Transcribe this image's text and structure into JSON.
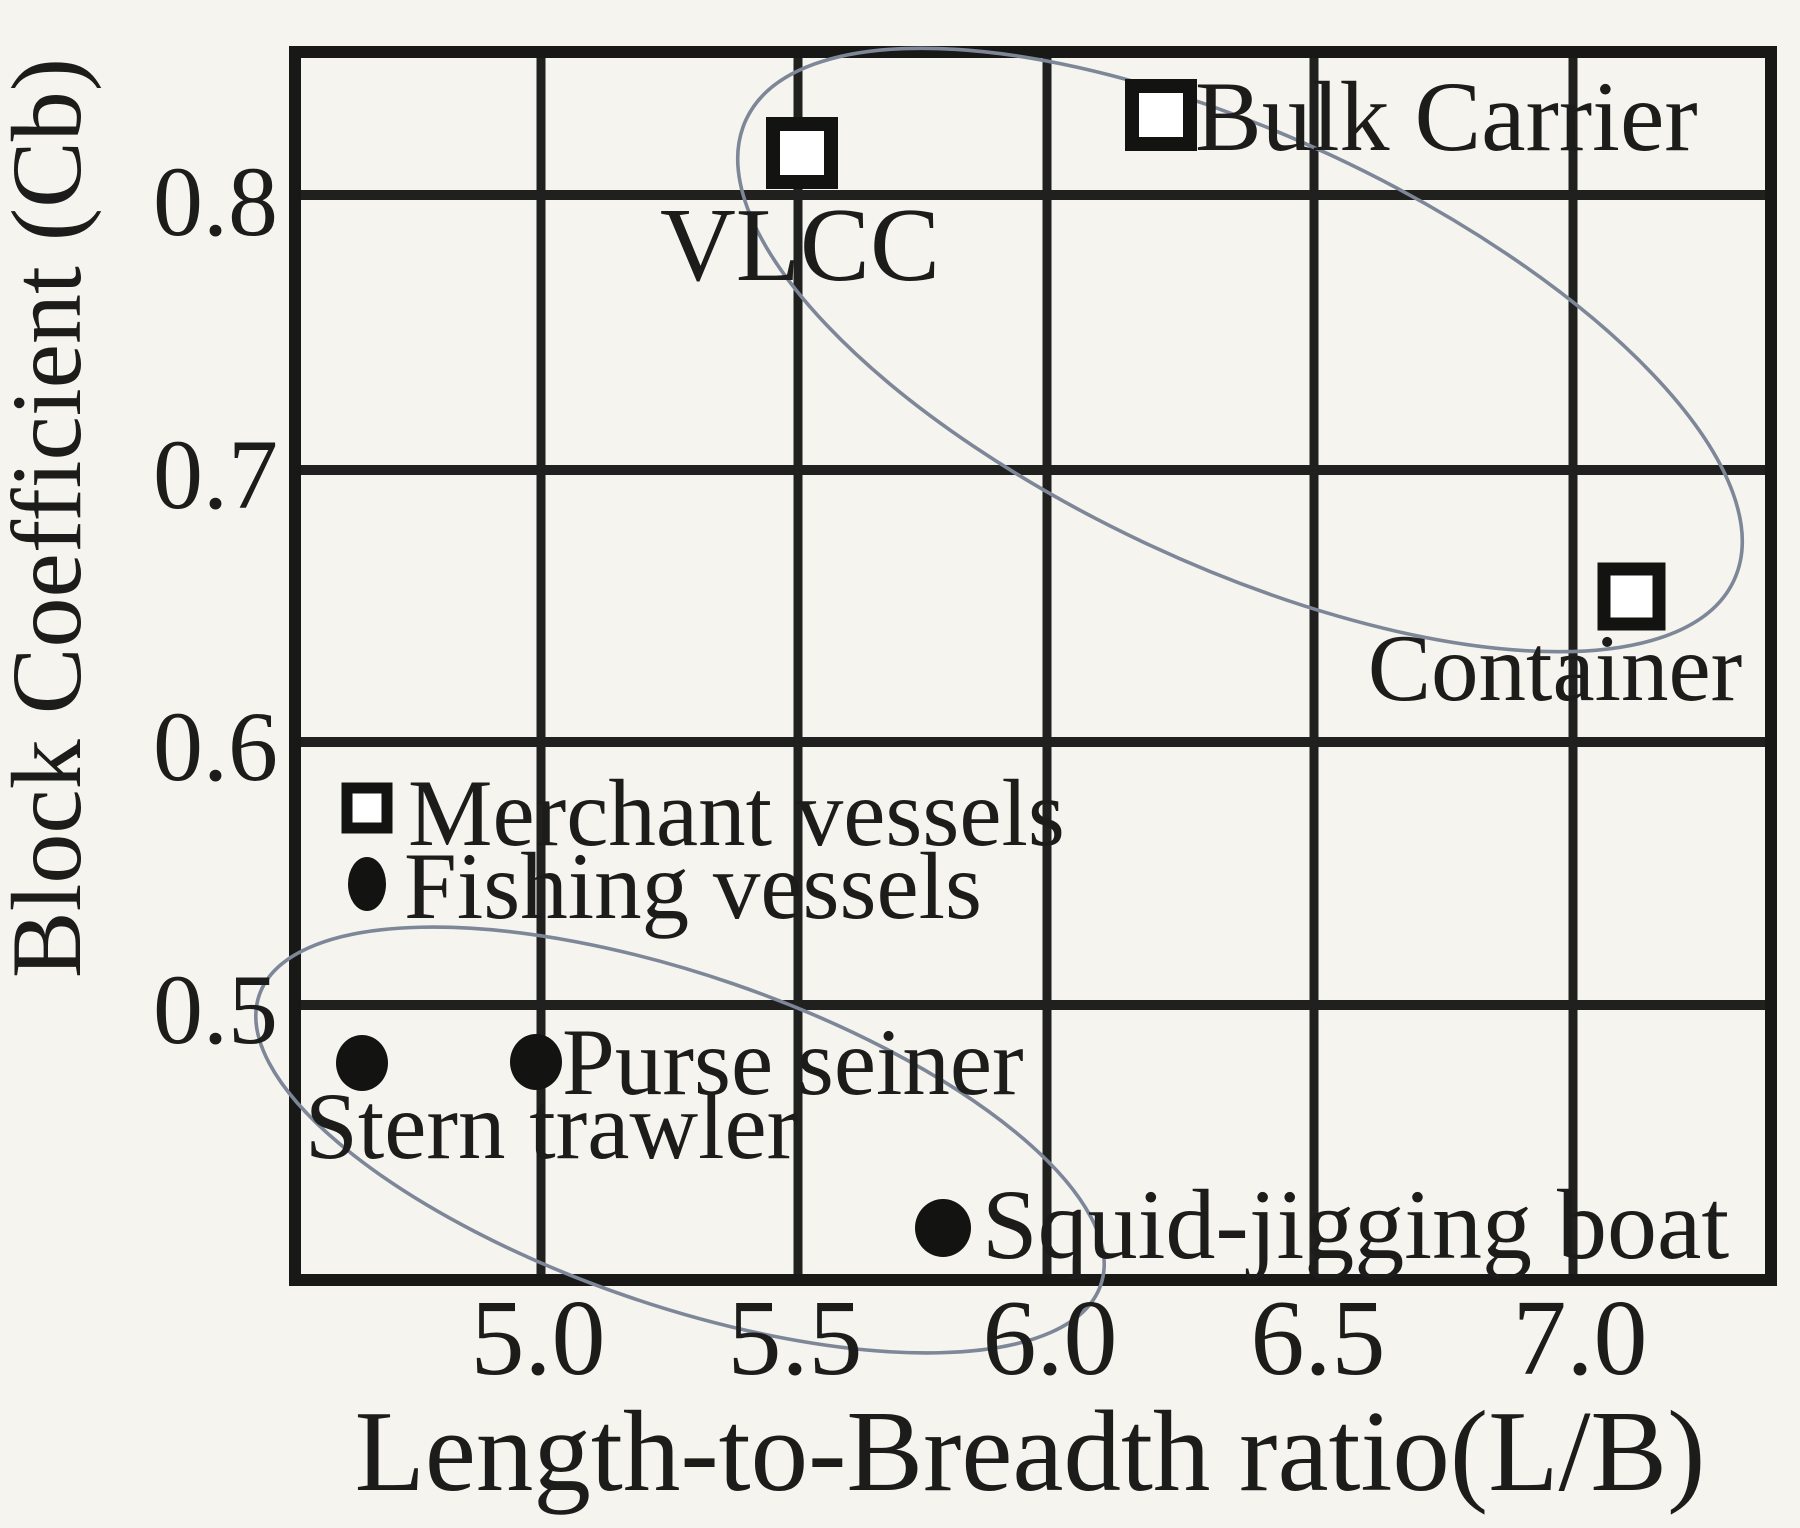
{
  "chart_data": {
    "type": "scatter",
    "title": "",
    "xlabel": "Length-to-Breadth ratio(L/B)",
    "ylabel": "Block Coefficient (Cb)",
    "x_ticks": [
      "5.0",
      "5.5",
      "6.0",
      "6.5",
      "7.0"
    ],
    "y_ticks": [
      "0.8",
      "0.7",
      "0.6",
      "0.5"
    ],
    "xlim": [
      4.53,
      7.39
    ],
    "ylim": [
      0.395,
      0.853
    ],
    "grid": true,
    "legend_position": "inside-middle-left",
    "series": [
      {
        "name": "Merchant vessels",
        "marker": "open-square",
        "points": [
          {
            "label": "VLCC",
            "x": 5.5,
            "y": 0.82
          },
          {
            "label": "Bulk Carrier",
            "x": 6.2,
            "y": 0.83
          },
          {
            "label": "Container",
            "x": 7.1,
            "y": 0.65
          }
        ]
      },
      {
        "name": "Fishing vessels",
        "marker": "filled-circle",
        "points": [
          {
            "label": "Stern trawler",
            "x": 4.65,
            "y": 0.48
          },
          {
            "label": "Purse seiner",
            "x": 5.0,
            "y": 0.48
          },
          {
            "label": "Squid-jigging boat",
            "x": 5.8,
            "y": 0.42
          }
        ]
      }
    ],
    "annotations": [
      {
        "type": "group-ellipse",
        "around": "Merchant vessels"
      },
      {
        "type": "group-ellipse",
        "around": "Fishing vessels"
      }
    ]
  },
  "colors": {
    "ink": "#1c1c1a",
    "grid_line": "#20201e",
    "group_ellipse": "#7d8798",
    "marker_fill": "#131311",
    "background": "#f5f4ef"
  }
}
